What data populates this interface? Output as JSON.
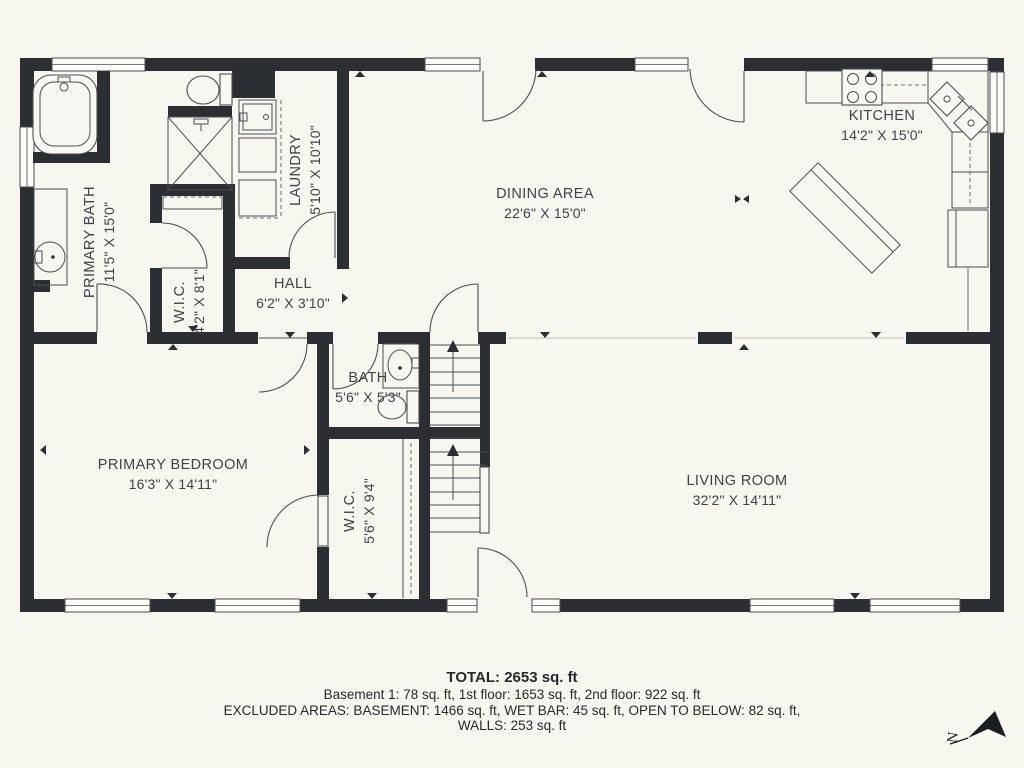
{
  "plan": {
    "rooms": [
      {
        "key": "primary_bath",
        "name": "PRIMARY BATH",
        "dims": "11'5\" X 15'0\""
      },
      {
        "key": "wic_upper",
        "name": "W.I.C.",
        "dims": "4'2\" X 8'1\""
      },
      {
        "key": "laundry",
        "name": "LAUNDRY",
        "dims": "5'10\" X 10'10\""
      },
      {
        "key": "hall",
        "name": "HALL",
        "dims": "6'2\" X 3'10\""
      },
      {
        "key": "dining_area",
        "name": "DINING AREA",
        "dims": "22'6\" X 15'0\""
      },
      {
        "key": "kitchen",
        "name": "KITCHEN",
        "dims": "14'2\" X 15'0\""
      },
      {
        "key": "bath",
        "name": "BATH",
        "dims": "5'6\" X 5'3\""
      },
      {
        "key": "primary_bedroom",
        "name": "PRIMARY BEDROOM",
        "dims": "16'3\" X 14'11\""
      },
      {
        "key": "wic_lower",
        "name": "W.I.C.",
        "dims": "5'6\" X 9'4\""
      },
      {
        "key": "living_room",
        "name": "LIVING ROOM",
        "dims": "32'2\" X 14'11\""
      }
    ],
    "compass_label": "N"
  },
  "summary": {
    "total": "TOTAL: 2653 sq. ft",
    "floors": "Basement 1: 78 sq. ft, 1st floor: 1653 sq. ft, 2nd floor: 922 sq. ft",
    "excluded": "EXCLUDED AREAS: BASEMENT: 1466 sq. ft, WET BAR: 45 sq. ft, OPEN TO BELOW: 82 sq. ft,",
    "walls": "WALLS: 253 sq. ft"
  },
  "colors": {
    "background": "#f7f6ef",
    "wall": "#2b2f33",
    "text": "#3d434a"
  }
}
